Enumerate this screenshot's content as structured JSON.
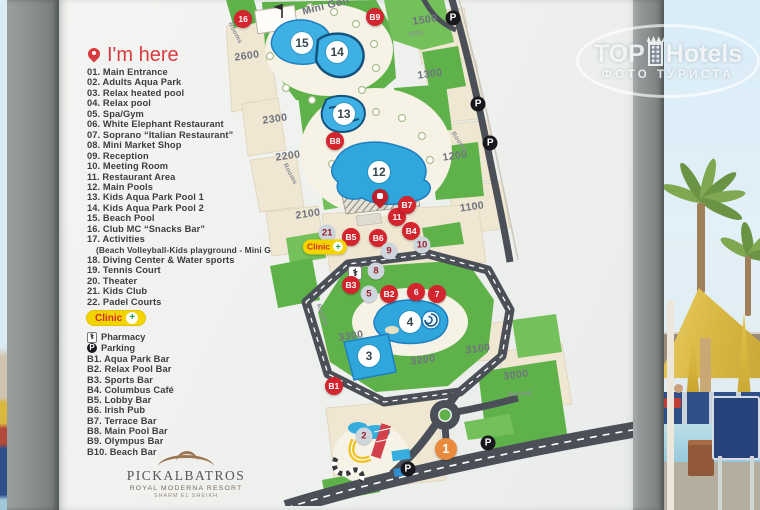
{
  "watermark": {
    "brand_top": "TOP",
    "brand_rest": "Hotels",
    "tagline": "ФОТО ТУРИСТА"
  },
  "sign": {
    "legend": {
      "title": "I'm here",
      "items": [
        {
          "text": "01. Main Entrance"
        },
        {
          "text": "02. Adults Aqua Park"
        },
        {
          "text": "03. Relax heated pool"
        },
        {
          "text": "04. Relax pool"
        },
        {
          "text": "05. Spa/Gym"
        },
        {
          "text": "06. White Elephant Restaurant"
        },
        {
          "text": "07. Soprano “Italian Restaurant”"
        },
        {
          "text": "08. Mini Market Shop"
        },
        {
          "text": "09. Reception"
        },
        {
          "text": "10. Meeting Room"
        },
        {
          "text": "11. Restaurant Area"
        },
        {
          "text": "12. Main Pools"
        },
        {
          "text": "13. Kids Aqua Park Pool 1"
        },
        {
          "text": "14. Kids Aqua Park Pool 2"
        },
        {
          "text": "15. Beach Pool"
        },
        {
          "text": "16. Club MC “Snacks Bar”"
        },
        {
          "text": "17. Activities"
        },
        {
          "text": "(Beach Volleyball-Kids playground - Mini Golf)",
          "type": "indent"
        },
        {
          "text": "18. Diving Center & Water sports"
        },
        {
          "text": "19. Tennis Court"
        },
        {
          "text": "20. Theater"
        },
        {
          "text": "21. Kids Club"
        },
        {
          "text": "22. Padel Courts"
        }
      ],
      "clinic_label": "Clinic",
      "pharmacy_icon": "⚕",
      "pharmacy_label": "Pharmacy",
      "parking_icon": "P",
      "parking_label": "Parking",
      "bars": [
        {
          "text": "B1. Aqua Park Bar"
        },
        {
          "text": "B2. Relax Pool Bar"
        },
        {
          "text": "B3. Sports Bar"
        },
        {
          "text": "B4. Columbus Café"
        },
        {
          "text": "B5. Lobby Bar"
        },
        {
          "text": "B6. Irish Pub"
        },
        {
          "text": "B7. Terrace Bar"
        },
        {
          "text": "B8. Main Pool Bar"
        },
        {
          "text": "B9. Olympus Bar"
        },
        {
          "text": "B10. Beach Bar"
        }
      ]
    },
    "logo": {
      "name": "PICKALBATROS",
      "subtitle": "ROYAL MODERNA RESORT",
      "location": "SHARM EL SHEIKH"
    }
  },
  "map": {
    "markers": [
      {
        "label": "16",
        "type": "red",
        "x": 4.1,
        "y": 3.8
      },
      {
        "label": "B9",
        "type": "red",
        "x": 35.6,
        "y": 3.4
      },
      {
        "label": "P",
        "type": "park",
        "name": "parking-marker",
        "x": 54.3,
        "y": 3.6
      },
      {
        "label": "15",
        "type": "pool",
        "x": 18.2,
        "y": 8.5
      },
      {
        "label": "14",
        "type": "pool",
        "x": 26.6,
        "y": 10.3
      },
      {
        "label": "13",
        "type": "pool",
        "x": 28.2,
        "y": 22.5
      },
      {
        "label": "B8",
        "type": "red",
        "x": 26.1,
        "y": 27.9
      },
      {
        "label": "12",
        "type": "pool",
        "x": 36.6,
        "y": 34.0
      },
      {
        "label": "P",
        "type": "park",
        "name": "parking-marker",
        "x": 60.3,
        "y": 20.6
      },
      {
        "label": "P",
        "type": "park",
        "name": "parking-marker",
        "x": 63.2,
        "y": 28.3
      },
      {
        "label": "",
        "type": "pin",
        "name": "im-here-pin",
        "x": 36.8,
        "y": 40.6
      },
      {
        "label": "11",
        "type": "red",
        "x": 40.9,
        "y": 42.9
      },
      {
        "label": "B7",
        "type": "red",
        "x": 43.3,
        "y": 40.5
      },
      {
        "label": "B4",
        "type": "red",
        "x": 44.3,
        "y": 45.7
      },
      {
        "label": "21",
        "type": "gray",
        "x": 24.2,
        "y": 46.0
      },
      {
        "label": "B5",
        "type": "red",
        "x": 29.9,
        "y": 46.8
      },
      {
        "label": "B6",
        "type": "red",
        "x": 36.4,
        "y": 47.0
      },
      {
        "label": "Clinic",
        "type": "clinic",
        "name": "clinic-badge",
        "x": 23.7,
        "y": 48.8
      },
      {
        "label": "10",
        "type": "gray",
        "x": 46.9,
        "y": 48.4
      },
      {
        "label": "9",
        "type": "gray",
        "x": 39.0,
        "y": 49.6
      },
      {
        "label": "8",
        "type": "gray",
        "x": 35.9,
        "y": 53.6
      },
      {
        "label": "⚕",
        "type": "medic",
        "name": "medical-icon",
        "x": 30.9,
        "y": 54.0
      },
      {
        "label": "B3",
        "type": "red",
        "x": 29.9,
        "y": 56.3
      },
      {
        "label": "5",
        "type": "gray",
        "x": 34.2,
        "y": 58.1
      },
      {
        "label": "B2",
        "type": "red",
        "x": 39.0,
        "y": 58.1
      },
      {
        "label": "6",
        "type": "red",
        "x": 45.5,
        "y": 57.7
      },
      {
        "label": "7",
        "type": "red",
        "x": 50.5,
        "y": 58.1
      },
      {
        "label": "4",
        "type": "pool",
        "x": 44.0,
        "y": 63.6
      },
      {
        "label": "3",
        "type": "pool",
        "x": 34.2,
        "y": 70.4
      },
      {
        "label": "B1",
        "type": "red",
        "x": 25.8,
        "y": 76.3
      },
      {
        "label": "2",
        "type": "gray",
        "x": 33.0,
        "y": 86.2
      },
      {
        "label": "1",
        "type": "orange",
        "x": 52.6,
        "y": 88.7
      },
      {
        "label": "P",
        "type": "park",
        "name": "parking-marker",
        "x": 43.5,
        "y": 92.7
      },
      {
        "label": "P",
        "type": "park",
        "name": "parking-marker",
        "x": 62.7,
        "y": 87.5
      }
    ],
    "labels": [
      {
        "text": "Mini Golf",
        "x": 24.0,
        "y": 1.2,
        "rot": -14
      },
      {
        "text": "1500",
        "x": 47.5,
        "y": 4.0,
        "rot": -8
      },
      {
        "text": "Villa",
        "x": 45.5,
        "y": 6.8,
        "rot": -8,
        "small": true
      },
      {
        "text": "Rooms",
        "x": 2.2,
        "y": 6.5,
        "rot": 62,
        "small": true
      },
      {
        "text": "2600",
        "x": 5.0,
        "y": 11.0,
        "rot": -8
      },
      {
        "text": "1300",
        "x": 48.8,
        "y": 14.6,
        "rot": -8
      },
      {
        "text": "2300",
        "x": 11.7,
        "y": 23.5,
        "rot": -8
      },
      {
        "text": "2200",
        "x": 14.8,
        "y": 30.8,
        "rot": -8
      },
      {
        "text": "Rooms",
        "x": 15.3,
        "y": 34.4,
        "rot": 62,
        "small": true
      },
      {
        "text": "1200",
        "x": 54.8,
        "y": 30.8,
        "rot": -8
      },
      {
        "text": "Rooms",
        "x": 55.7,
        "y": 28.0,
        "rot": 55,
        "small": true
      },
      {
        "text": "1100",
        "x": 58.9,
        "y": 40.9,
        "rot": -8
      },
      {
        "text": "2100",
        "x": 19.6,
        "y": 42.3,
        "rot": -8
      },
      {
        "text": "Rooms",
        "x": 23.0,
        "y": 62.2,
        "rot": 70,
        "small": true
      },
      {
        "text": "3300",
        "x": 29.9,
        "y": 66.4,
        "rot": -8
      },
      {
        "text": "3200",
        "x": 47.1,
        "y": 71.1,
        "rot": -8
      },
      {
        "text": "3100",
        "x": 60.3,
        "y": 69.0,
        "rot": -8
      },
      {
        "text": "3000",
        "x": 69.4,
        "y": 74.1,
        "rot": -8
      },
      {
        "text": "Rooms",
        "x": 70.4,
        "y": 77.9,
        "rot": -4,
        "small": true
      }
    ]
  }
}
